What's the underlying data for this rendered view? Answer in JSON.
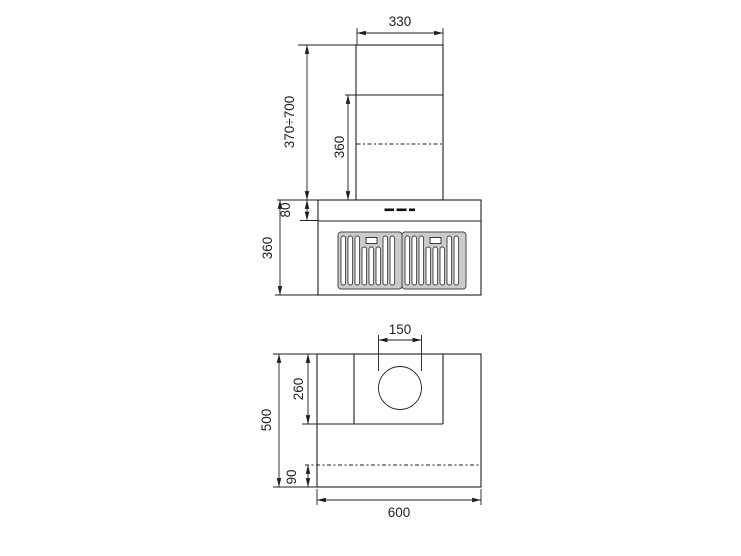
{
  "front_view": {
    "dimensions": {
      "chimney_width": "330",
      "mounting_height_range": "370÷700",
      "lower_chimney_height": "360",
      "control_band_height": "80",
      "body_height": "360"
    }
  },
  "plan_view": {
    "dimensions": {
      "duct_diameter": "150",
      "duct_box_depth": "260",
      "total_depth": "500",
      "rear_section_depth": "90",
      "body_width": "600"
    }
  },
  "colors": {
    "line": "#1f1f1f",
    "filter_panel_fill": "#cbcbcb",
    "background": "#ffffff"
  }
}
